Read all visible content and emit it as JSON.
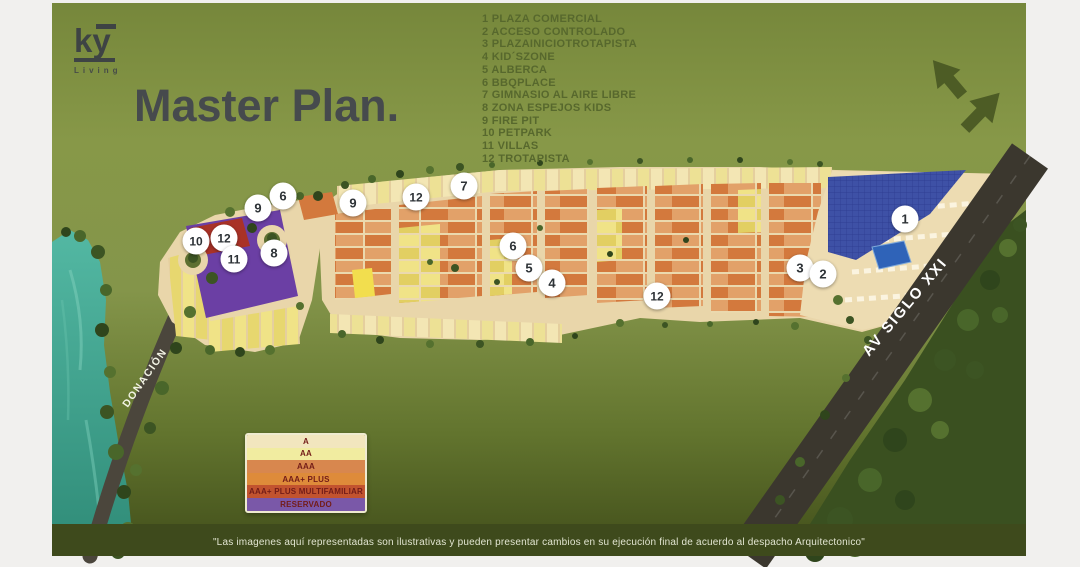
{
  "brand": {
    "logo_text": "ky",
    "logo_sub": "Living"
  },
  "title": "Master Plan.",
  "amenities": [
    {
      "num": "1",
      "label": "PLAZA COMERCIAL"
    },
    {
      "num": "2",
      "label": "ACCESO CONTROLADO"
    },
    {
      "num": "3",
      "label": "PLAZAINICIOTROTAPISTA"
    },
    {
      "num": "4",
      "label": "KID´SZONE"
    },
    {
      "num": "5",
      "label": "ALBERCA"
    },
    {
      "num": "6",
      "label": "BBQPLACE"
    },
    {
      "num": "7",
      "label": "GIMNASIO AL AIRE LIBRE"
    },
    {
      "num": "8",
      "label": "ZONA ESPEJOS KIDS"
    },
    {
      "num": "9",
      "label": "FIRE PIT"
    },
    {
      "num": "10",
      "label": "PETPARK"
    },
    {
      "num": "11",
      "label": "VILLAS"
    },
    {
      "num": "12",
      "label": "TROTAPISTA"
    }
  ],
  "map": {
    "av_label": "AV SIGLO XXI",
    "donacion_label": "DONACIÓN",
    "markers": [
      {
        "num": "6",
        "x": 283,
        "y": 196
      },
      {
        "num": "9",
        "x": 258,
        "y": 208
      },
      {
        "num": "10",
        "x": 196,
        "y": 241
      },
      {
        "num": "12",
        "x": 224,
        "y": 238
      },
      {
        "num": "11",
        "x": 234,
        "y": 259
      },
      {
        "num": "8",
        "x": 274,
        "y": 253
      },
      {
        "num": "9",
        "x": 353,
        "y": 203
      },
      {
        "num": "12",
        "x": 416,
        "y": 197
      },
      {
        "num": "7",
        "x": 464,
        "y": 186
      },
      {
        "num": "6",
        "x": 513,
        "y": 246
      },
      {
        "num": "5",
        "x": 529,
        "y": 268
      },
      {
        "num": "4",
        "x": 552,
        "y": 283
      },
      {
        "num": "12",
        "x": 657,
        "y": 296
      },
      {
        "num": "3",
        "x": 800,
        "y": 268
      },
      {
        "num": "2",
        "x": 823,
        "y": 274
      },
      {
        "num": "1",
        "x": 905,
        "y": 219
      }
    ]
  },
  "lot_legend": [
    {
      "label": "A",
      "color": "#F2E6BE"
    },
    {
      "label": "AA",
      "color": "#F1ECA0"
    },
    {
      "label": "AAA",
      "color": "#D8874E"
    },
    {
      "label": "AAA+ PLUS",
      "color": "#DE8B3A"
    },
    {
      "label": "AAA+ PLUS MULTIFAMILIAR",
      "color": "#C2532F"
    },
    {
      "label": "RESERVADO",
      "color": "#7A58A8"
    }
  ],
  "disclaimer": "\"Las imagenes aquí representadas son ilustrativas y pueden presentar cambios en su ejecución final de acuerdo al despacho Arquitectonico\"",
  "colors": {
    "background_green": "#84954a",
    "water_teal": "#3aa38f",
    "platform_tan": "#e9d6aa",
    "reserved_purple": "#6b3fa4",
    "multifamily_red": "#a93227",
    "solar_roof_blue": "#3e51a6",
    "road_dark": "#3b372e",
    "footer_green": "#3e4a1c"
  }
}
